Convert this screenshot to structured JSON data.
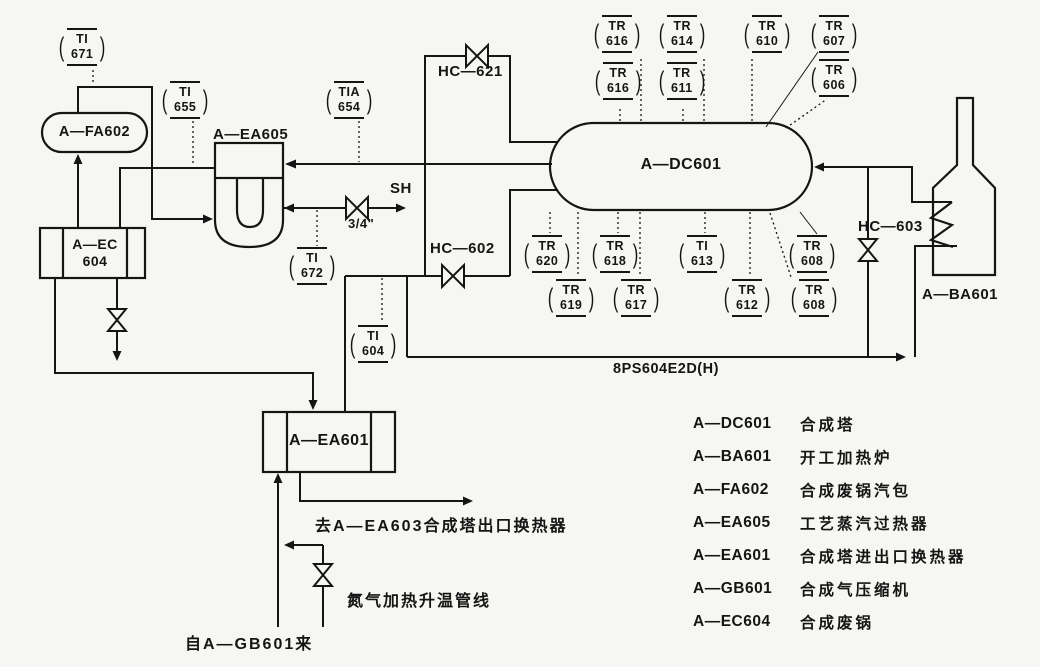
{
  "diagram": {
    "equipment": {
      "dc601": "A—DC601",
      "fa602": "A—FA602",
      "ea605": "A—EA605",
      "ec604_l1": "A—EC",
      "ec604_l2": "604",
      "ea601": "A—EA601",
      "ba601": "A—BA601"
    },
    "valves": {
      "hc621": "HC—621",
      "hc602": "HC—602",
      "hc603": "HC—603",
      "sh": "SH",
      "size34": "3/4\""
    },
    "line_label": "8PS604E2D(H)",
    "notes": {
      "to_ea603": "去A—EA603合成塔出口换热器",
      "n2_line": "氮气加热升温管线",
      "from_gb601": "自A—GB601来"
    },
    "instruments": {
      "ti671": {
        "l1": "TI",
        "l2": "671"
      },
      "ti655": {
        "l1": "TI",
        "l2": "655"
      },
      "tia654": {
        "l1": "TIA",
        "l2": "654"
      },
      "ti672": {
        "l1": "TI",
        "l2": "672"
      },
      "ti604": {
        "l1": "TI",
        "l2": "604"
      },
      "tr616a": {
        "l1": "TR",
        "l2": "616"
      },
      "tr614": {
        "l1": "TR",
        "l2": "614"
      },
      "tr610": {
        "l1": "TR",
        "l2": "610"
      },
      "tr607": {
        "l1": "TR",
        "l2": "607"
      },
      "tr616b": {
        "l1": "TR",
        "l2": "616"
      },
      "tr611": {
        "l1": "TR",
        "l2": "611"
      },
      "tr606": {
        "l1": "TR",
        "l2": "606"
      },
      "tr620": {
        "l1": "TR",
        "l2": "620"
      },
      "tr618": {
        "l1": "TR",
        "l2": "618"
      },
      "ti613": {
        "l1": "TI",
        "l2": "613"
      },
      "tr608a": {
        "l1": "TR",
        "l2": "608"
      },
      "tr619": {
        "l1": "TR",
        "l2": "619"
      },
      "tr617": {
        "l1": "TR",
        "l2": "617"
      },
      "tr612": {
        "l1": "TR",
        "l2": "612"
      },
      "tr608b": {
        "l1": "TR",
        "l2": "608"
      }
    },
    "legend": {
      "items": [
        {
          "code": "A—DC601",
          "desc": "合成塔"
        },
        {
          "code": "A—BA601",
          "desc": "开工加热炉"
        },
        {
          "code": "A—FA602",
          "desc": "合成废锅汽包"
        },
        {
          "code": "A—EA605",
          "desc": "工艺蒸汽过热器"
        },
        {
          "code": "A—EA601",
          "desc": "合成塔进出口换热器"
        },
        {
          "code": "A—GB601",
          "desc": "合成气压缩机"
        },
        {
          "code": "A—EC604",
          "desc": "合成废锅"
        }
      ]
    }
  }
}
